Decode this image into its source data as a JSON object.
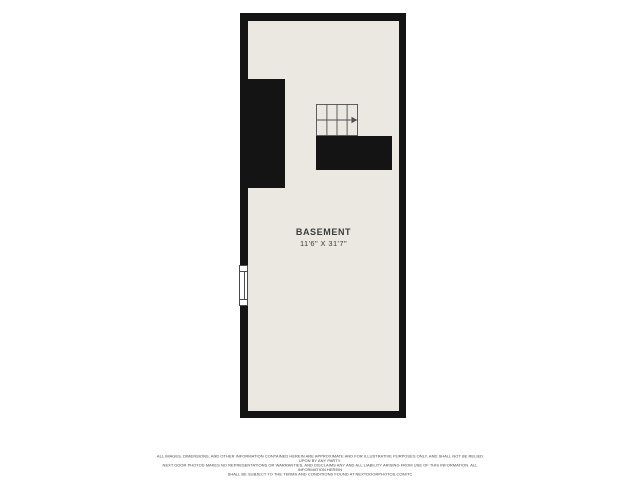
{
  "floor_plan": {
    "room": {
      "name": "BASEMENT",
      "dimensions": "11'6\" X 31'7\""
    },
    "stairs": {
      "columns": 4,
      "rows": 2,
      "direction_arrow": "right"
    },
    "features": [
      "window-left-wall",
      "wall-jog-left",
      "wall-under-stairs"
    ],
    "colors": {
      "wall": "#141414",
      "floor": "#eae8e0",
      "stair_line": "#4f4f4f",
      "label_text": "#3c3c3c",
      "window_fill": "#ffffff",
      "window_frame": "#4a4a4a",
      "page_bg": "#ffffff"
    }
  },
  "disclaimer": {
    "lines": [
      "ALL IMAGES, DIMENSIONS, AND OTHER INFORMATION CONTAINED HEREIN ARE APPROXIMATE AND FOR ILLUSTRATIVE PURPOSES ONLY, AND SHALL NOT BE RELIED UPON BY ANY PARTY.",
      "NEXT DOOR PHOTOS MAKES NO REPRESENTATIONS OR WARRANTIES, AND DISCLAIMS ANY AND ALL LIABILITY ARISING FROM USE OF THIS INFORMATION. ALL INFORMATION HEREIN",
      "SHALL BE SUBJECT TO THE TERMS AND CONDITIONS FOUND AT NEXTDOORPHOTOS.COM/TC"
    ]
  }
}
